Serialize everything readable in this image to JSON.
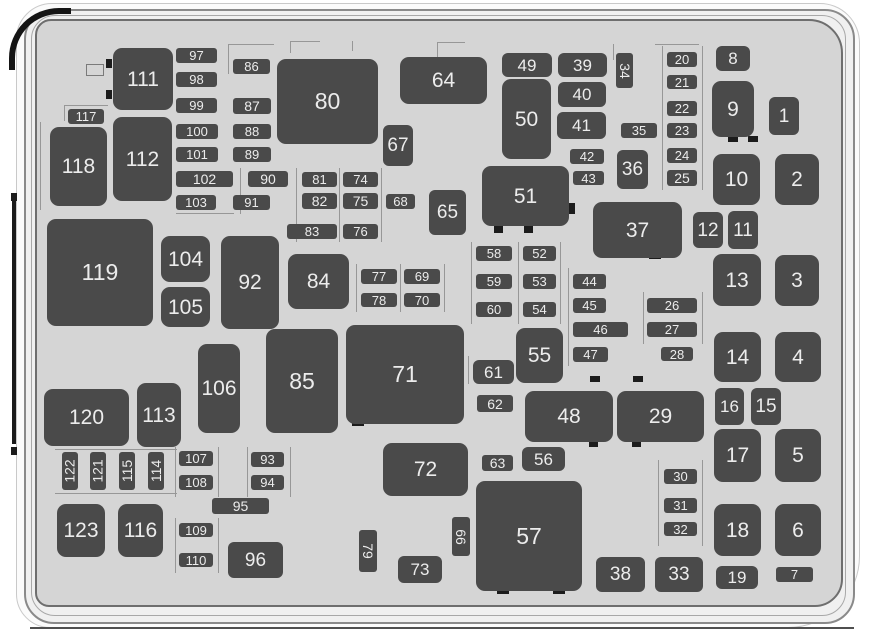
{
  "diagram": {
    "type": "engine-compartment-fuse-box-diagram",
    "colors": {
      "panel": "#d5d5d5",
      "cover": "#f0f0f0",
      "fuse_fill": "#4a4a4a",
      "fuse_label": "#ececec",
      "outline": "#8a8a8a",
      "frame_accent": "#1a1a1a"
    },
    "fuses": [
      {
        "n": "1",
        "x": 769,
        "y": 97,
        "w": 30,
        "h": 38
      },
      {
        "n": "2",
        "x": 775,
        "y": 154,
        "w": 44,
        "h": 51
      },
      {
        "n": "3",
        "x": 775,
        "y": 255,
        "w": 44,
        "h": 51
      },
      {
        "n": "4",
        "x": 775,
        "y": 332,
        "w": 46,
        "h": 50
      },
      {
        "n": "5",
        "x": 775,
        "y": 429,
        "w": 46,
        "h": 53
      },
      {
        "n": "6",
        "x": 775,
        "y": 504,
        "w": 46,
        "h": 52
      },
      {
        "n": "7",
        "x": 776,
        "y": 567,
        "w": 37,
        "h": 15
      },
      {
        "n": "8",
        "x": 716,
        "y": 46,
        "w": 34,
        "h": 25
      },
      {
        "n": "9",
        "x": 712,
        "y": 81,
        "w": 42,
        "h": 56
      },
      {
        "n": "10",
        "x": 713,
        "y": 154,
        "w": 47,
        "h": 51
      },
      {
        "n": "11",
        "x": 728,
        "y": 211,
        "w": 30,
        "h": 38
      },
      {
        "n": "12",
        "x": 693,
        "y": 212,
        "w": 30,
        "h": 36
      },
      {
        "n": "13",
        "x": 713,
        "y": 254,
        "w": 48,
        "h": 52
      },
      {
        "n": "14",
        "x": 714,
        "y": 332,
        "w": 47,
        "h": 50
      },
      {
        "n": "15",
        "x": 751,
        "y": 388,
        "w": 30,
        "h": 37
      },
      {
        "n": "16",
        "x": 715,
        "y": 388,
        "w": 29,
        "h": 37
      },
      {
        "n": "17",
        "x": 714,
        "y": 429,
        "w": 47,
        "h": 53
      },
      {
        "n": "18",
        "x": 714,
        "y": 504,
        "w": 47,
        "h": 52
      },
      {
        "n": "19",
        "x": 716,
        "y": 566,
        "w": 42,
        "h": 23
      },
      {
        "n": "20",
        "x": 667,
        "y": 52,
        "w": 30,
        "h": 15
      },
      {
        "n": "21",
        "x": 667,
        "y": 75,
        "w": 30,
        "h": 14
      },
      {
        "n": "22",
        "x": 667,
        "y": 101,
        "w": 30,
        "h": 15
      },
      {
        "n": "23",
        "x": 667,
        "y": 123,
        "w": 30,
        "h": 15
      },
      {
        "n": "24",
        "x": 667,
        "y": 148,
        "w": 30,
        "h": 15
      },
      {
        "n": "25",
        "x": 667,
        "y": 170,
        "w": 30,
        "h": 16
      },
      {
        "n": "26",
        "x": 647,
        "y": 298,
        "w": 50,
        "h": 15
      },
      {
        "n": "27",
        "x": 647,
        "y": 322,
        "w": 50,
        "h": 15
      },
      {
        "n": "28",
        "x": 661,
        "y": 347,
        "w": 32,
        "h": 14
      },
      {
        "n": "29",
        "x": 617,
        "y": 391,
        "w": 87,
        "h": 51
      },
      {
        "n": "30",
        "x": 664,
        "y": 469,
        "w": 33,
        "h": 15
      },
      {
        "n": "31",
        "x": 664,
        "y": 498,
        "w": 33,
        "h": 15
      },
      {
        "n": "32",
        "x": 664,
        "y": 522,
        "w": 33,
        "h": 14
      },
      {
        "n": "33",
        "x": 655,
        "y": 557,
        "w": 48,
        "h": 35
      },
      {
        "n": "34",
        "x": 616,
        "y": 53,
        "w": 17,
        "h": 35,
        "v": "cw"
      },
      {
        "n": "35",
        "x": 621,
        "y": 123,
        "w": 36,
        "h": 15
      },
      {
        "n": "36",
        "x": 617,
        "y": 150,
        "w": 31,
        "h": 39
      },
      {
        "n": "37",
        "x": 593,
        "y": 202,
        "w": 89,
        "h": 56
      },
      {
        "n": "38",
        "x": 596,
        "y": 557,
        "w": 49,
        "h": 35
      },
      {
        "n": "39",
        "x": 558,
        "y": 53,
        "w": 49,
        "h": 24
      },
      {
        "n": "40",
        "x": 558,
        "y": 82,
        "w": 48,
        "h": 25
      },
      {
        "n": "41",
        "x": 557,
        "y": 112,
        "w": 49,
        "h": 27
      },
      {
        "n": "42",
        "x": 570,
        "y": 149,
        "w": 34,
        "h": 15
      },
      {
        "n": "43",
        "x": 573,
        "y": 171,
        "w": 31,
        "h": 14
      },
      {
        "n": "44",
        "x": 573,
        "y": 274,
        "w": 33,
        "h": 15
      },
      {
        "n": "45",
        "x": 573,
        "y": 298,
        "w": 33,
        "h": 15
      },
      {
        "n": "46",
        "x": 573,
        "y": 322,
        "w": 55,
        "h": 15
      },
      {
        "n": "47",
        "x": 573,
        "y": 347,
        "w": 35,
        "h": 15
      },
      {
        "n": "48",
        "x": 525,
        "y": 391,
        "w": 88,
        "h": 51
      },
      {
        "n": "49",
        "x": 502,
        "y": 53,
        "w": 50,
        "h": 24
      },
      {
        "n": "50",
        "x": 502,
        "y": 79,
        "w": 49,
        "h": 80
      },
      {
        "n": "51",
        "x": 482,
        "y": 166,
        "w": 87,
        "h": 60
      },
      {
        "n": "52",
        "x": 523,
        "y": 246,
        "w": 33,
        "h": 15
      },
      {
        "n": "53",
        "x": 523,
        "y": 274,
        "w": 33,
        "h": 15
      },
      {
        "n": "54",
        "x": 523,
        "y": 302,
        "w": 33,
        "h": 15
      },
      {
        "n": "55",
        "x": 516,
        "y": 328,
        "w": 47,
        "h": 55
      },
      {
        "n": "56",
        "x": 522,
        "y": 447,
        "w": 43,
        "h": 24
      },
      {
        "n": "57",
        "x": 476,
        "y": 481,
        "w": 106,
        "h": 110
      },
      {
        "n": "58",
        "x": 476,
        "y": 246,
        "w": 36,
        "h": 15
      },
      {
        "n": "59",
        "x": 476,
        "y": 274,
        "w": 36,
        "h": 15
      },
      {
        "n": "60",
        "x": 476,
        "y": 302,
        "w": 36,
        "h": 15
      },
      {
        "n": "61",
        "x": 473,
        "y": 360,
        "w": 41,
        "h": 24
      },
      {
        "n": "62",
        "x": 477,
        "y": 395,
        "w": 36,
        "h": 17
      },
      {
        "n": "63",
        "x": 482,
        "y": 455,
        "w": 31,
        "h": 16
      },
      {
        "n": "64",
        "x": 400,
        "y": 57,
        "w": 87,
        "h": 47
      },
      {
        "n": "65",
        "x": 429,
        "y": 190,
        "w": 37,
        "h": 45
      },
      {
        "n": "66",
        "x": 452,
        "y": 517,
        "w": 18,
        "h": 39,
        "v": "cw"
      },
      {
        "n": "67",
        "x": 383,
        "y": 125,
        "w": 30,
        "h": 41
      },
      {
        "n": "68",
        "x": 386,
        "y": 194,
        "w": 29,
        "h": 15
      },
      {
        "n": "69",
        "x": 404,
        "y": 269,
        "w": 36,
        "h": 15
      },
      {
        "n": "70",
        "x": 404,
        "y": 293,
        "w": 36,
        "h": 14
      },
      {
        "n": "71",
        "x": 346,
        "y": 325,
        "w": 118,
        "h": 99
      },
      {
        "n": "72",
        "x": 383,
        "y": 443,
        "w": 85,
        "h": 53
      },
      {
        "n": "73",
        "x": 398,
        "y": 556,
        "w": 44,
        "h": 27
      },
      {
        "n": "74",
        "x": 343,
        "y": 172,
        "w": 35,
        "h": 15
      },
      {
        "n": "75",
        "x": 343,
        "y": 193,
        "w": 35,
        "h": 16
      },
      {
        "n": "76",
        "x": 343,
        "y": 224,
        "w": 35,
        "h": 15
      },
      {
        "n": "77",
        "x": 361,
        "y": 269,
        "w": 36,
        "h": 15
      },
      {
        "n": "78",
        "x": 361,
        "y": 293,
        "w": 36,
        "h": 14
      },
      {
        "n": "79",
        "x": 359,
        "y": 530,
        "w": 18,
        "h": 42,
        "v": "cw"
      },
      {
        "n": "80",
        "x": 277,
        "y": 59,
        "w": 101,
        "h": 85
      },
      {
        "n": "81",
        "x": 302,
        "y": 172,
        "w": 35,
        "h": 15
      },
      {
        "n": "82",
        "x": 302,
        "y": 193,
        "w": 35,
        "h": 16
      },
      {
        "n": "83",
        "x": 287,
        "y": 224,
        "w": 50,
        "h": 15
      },
      {
        "n": "84",
        "x": 288,
        "y": 254,
        "w": 61,
        "h": 55
      },
      {
        "n": "85",
        "x": 266,
        "y": 329,
        "w": 72,
        "h": 104
      },
      {
        "n": "86",
        "x": 233,
        "y": 59,
        "w": 37,
        "h": 15
      },
      {
        "n": "87",
        "x": 233,
        "y": 98,
        "w": 38,
        "h": 16
      },
      {
        "n": "88",
        "x": 233,
        "y": 124,
        "w": 38,
        "h": 15
      },
      {
        "n": "89",
        "x": 233,
        "y": 147,
        "w": 38,
        "h": 15
      },
      {
        "n": "90",
        "x": 248,
        "y": 171,
        "w": 40,
        "h": 16
      },
      {
        "n": "91",
        "x": 233,
        "y": 195,
        "w": 37,
        "h": 15
      },
      {
        "n": "92",
        "x": 221,
        "y": 236,
        "w": 58,
        "h": 93
      },
      {
        "n": "93",
        "x": 251,
        "y": 452,
        "w": 33,
        "h": 15
      },
      {
        "n": "94",
        "x": 251,
        "y": 475,
        "w": 33,
        "h": 15
      },
      {
        "n": "95",
        "x": 212,
        "y": 498,
        "w": 57,
        "h": 16
      },
      {
        "n": "96",
        "x": 228,
        "y": 542,
        "w": 55,
        "h": 36
      },
      {
        "n": "97",
        "x": 176,
        "y": 48,
        "w": 41,
        "h": 15
      },
      {
        "n": "98",
        "x": 176,
        "y": 72,
        "w": 41,
        "h": 15
      },
      {
        "n": "99",
        "x": 176,
        "y": 98,
        "w": 41,
        "h": 15
      },
      {
        "n": "100",
        "x": 176,
        "y": 124,
        "w": 42,
        "h": 15
      },
      {
        "n": "101",
        "x": 176,
        "y": 147,
        "w": 42,
        "h": 15
      },
      {
        "n": "102",
        "x": 176,
        "y": 171,
        "w": 57,
        "h": 16
      },
      {
        "n": "103",
        "x": 176,
        "y": 195,
        "w": 40,
        "h": 15
      },
      {
        "n": "104",
        "x": 161,
        "y": 236,
        "w": 49,
        "h": 46
      },
      {
        "n": "105",
        "x": 161,
        "y": 287,
        "w": 49,
        "h": 40
      },
      {
        "n": "106",
        "x": 198,
        "y": 344,
        "w": 42,
        "h": 89
      },
      {
        "n": "107",
        "x": 179,
        "y": 451,
        "w": 34,
        "h": 15
      },
      {
        "n": "108",
        "x": 179,
        "y": 475,
        "w": 34,
        "h": 15
      },
      {
        "n": "109",
        "x": 179,
        "y": 523,
        "w": 34,
        "h": 14
      },
      {
        "n": "110",
        "x": 179,
        "y": 553,
        "w": 34,
        "h": 14
      },
      {
        "n": "111",
        "x": 113,
        "y": 48,
        "w": 60,
        "h": 62
      },
      {
        "n": "112",
        "x": 113,
        "y": 117,
        "w": 59,
        "h": 84
      },
      {
        "n": "113",
        "x": 137,
        "y": 383,
        "w": 44,
        "h": 64
      },
      {
        "n": "114",
        "x": 148,
        "y": 452,
        "w": 16,
        "h": 38,
        "v": "ccw"
      },
      {
        "n": "115",
        "x": 119,
        "y": 452,
        "w": 16,
        "h": 38,
        "v": "ccw"
      },
      {
        "n": "116",
        "x": 118,
        "y": 504,
        "w": 45,
        "h": 53
      },
      {
        "n": "117",
        "x": 68,
        "y": 109,
        "w": 36,
        "h": 15
      },
      {
        "n": "118",
        "x": 50,
        "y": 127,
        "w": 57,
        "h": 79
      },
      {
        "n": "119",
        "x": 47,
        "y": 219,
        "w": 106,
        "h": 107
      },
      {
        "n": "120",
        "x": 44,
        "y": 389,
        "w": 85,
        "h": 57
      },
      {
        "n": "121",
        "x": 90,
        "y": 452,
        "w": 16,
        "h": 38,
        "v": "ccw"
      },
      {
        "n": "122",
        "x": 62,
        "y": 452,
        "w": 16,
        "h": 38,
        "v": "ccw"
      },
      {
        "n": "123",
        "x": 57,
        "y": 504,
        "w": 48,
        "h": 53
      }
    ]
  }
}
